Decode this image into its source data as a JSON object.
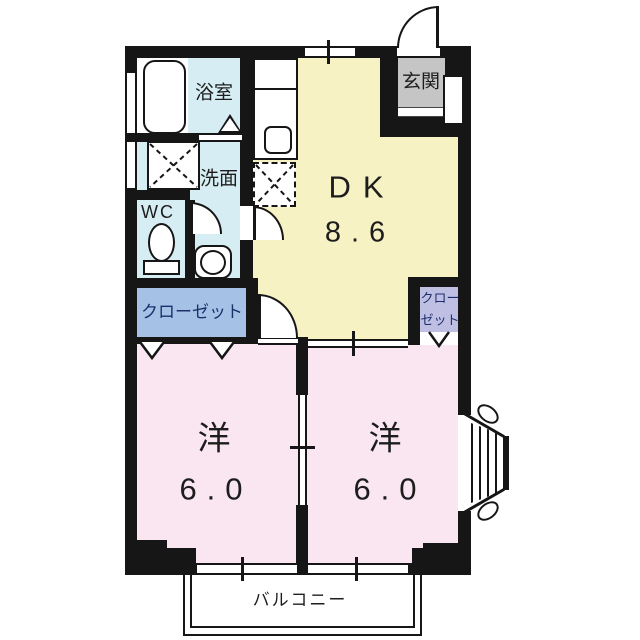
{
  "plan": {
    "type": "japanese-apartment-floor-plan",
    "colors": {
      "wall": "#161616",
      "dk": "#F7F2C3",
      "bedroom": "#F9E6F0",
      "sanitary": "#D6EDF4",
      "entrance": "#C5C5C5",
      "closetL": "#A5C2E6",
      "closetR": "#BFBFE4",
      "navy": "#1D2F6B"
    },
    "rooms": {
      "bath": {
        "label": "浴室"
      },
      "washroom": {
        "label": "洗面"
      },
      "wc": {
        "label": "WC"
      },
      "entrance": {
        "label": "玄関"
      },
      "dk": {
        "label": "DK",
        "area": "8.6"
      },
      "closet_left": {
        "label": "クローゼット"
      },
      "closet_right": {
        "label_line1": "クロー",
        "label_line2": "ゼット"
      },
      "bedroom_left": {
        "label": "洋",
        "area": "6.0"
      },
      "bedroom_right": {
        "label": "洋",
        "area": "6.0"
      },
      "balcony": {
        "label": "バルコニー"
      }
    },
    "fixtures": [
      "bathtub",
      "washing-machine-space",
      "washbasin",
      "toilet",
      "kitchen-counter",
      "kitchen-sink",
      "refrigerator-space",
      "bay-window"
    ],
    "door_marks": [
      "hinged-door-arc",
      "folding-door-chevron",
      "sliding-door-rail",
      "window-tick"
    ]
  }
}
